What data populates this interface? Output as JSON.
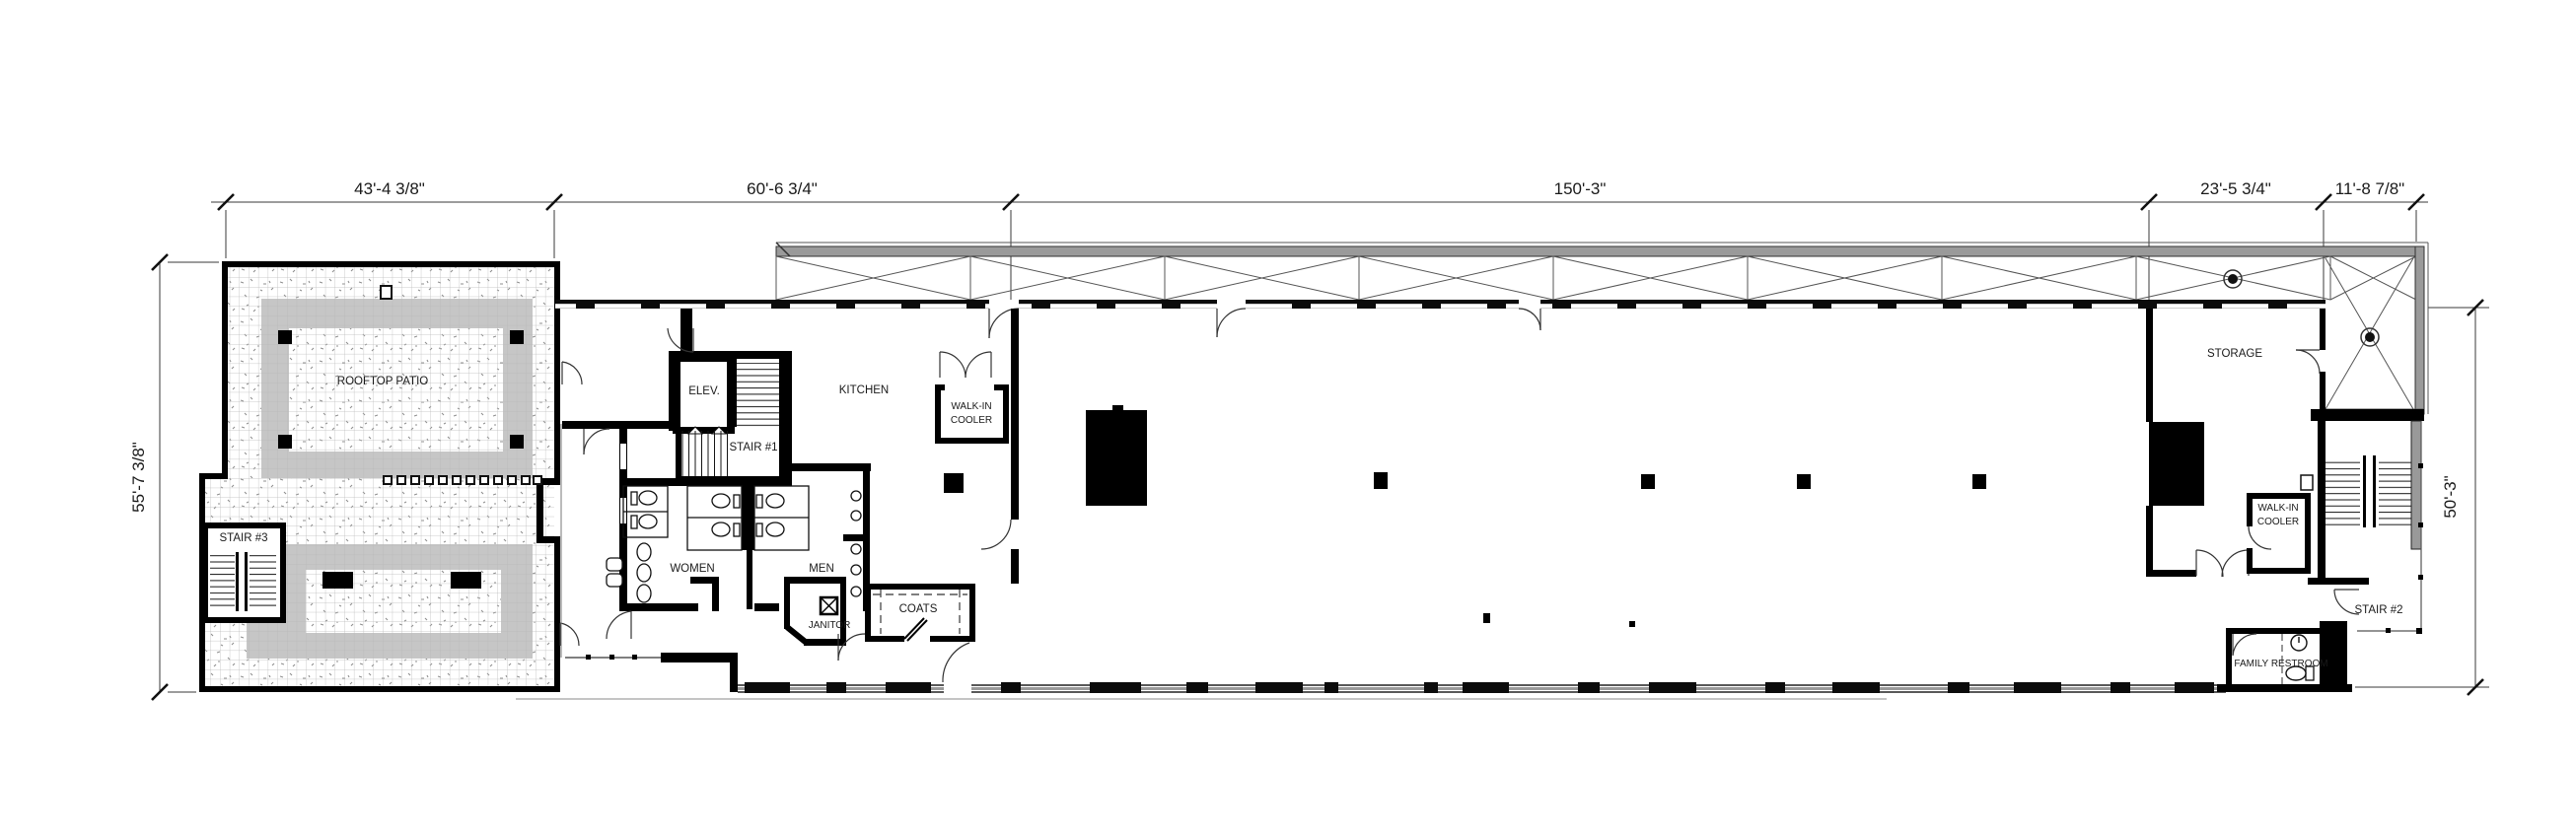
{
  "plan": {
    "type": "architectural-floor-plan",
    "dimensions_top": [
      "43'-4 3/8\"",
      "60'-6 3/4\"",
      "150'-3\"",
      "23'-5 3/4\"",
      "11'-8 7/8\""
    ],
    "dimension_left": "55'-7 3/8\"",
    "dimension_right": "50'-3\"",
    "rooms": {
      "rooftop_patio": "ROOFTOP PATIO",
      "stair_3": "STAIR #3",
      "elevator": "ELEV.",
      "stair_1": "STAIR #1",
      "kitchen": "KITCHEN",
      "cooler_kitchen_line1": "WALK-IN",
      "cooler_kitchen_line2": "COOLER",
      "women": "WOMEN",
      "men": "MEN",
      "janitor": "JANITOR",
      "coats": "COATS",
      "storage": "STORAGE",
      "cooler_storage_line1": "WALK-IN",
      "cooler_storage_line2": "COOLER",
      "stair_2": "STAIR #2",
      "family_restroom": "FAMILY RESTROOM"
    },
    "colors": {
      "walls": "#000000",
      "walkway_gray": "#c6c6c6",
      "canopy_gray": "#9a9a9a",
      "thin_line": "#3a3a3a"
    }
  }
}
